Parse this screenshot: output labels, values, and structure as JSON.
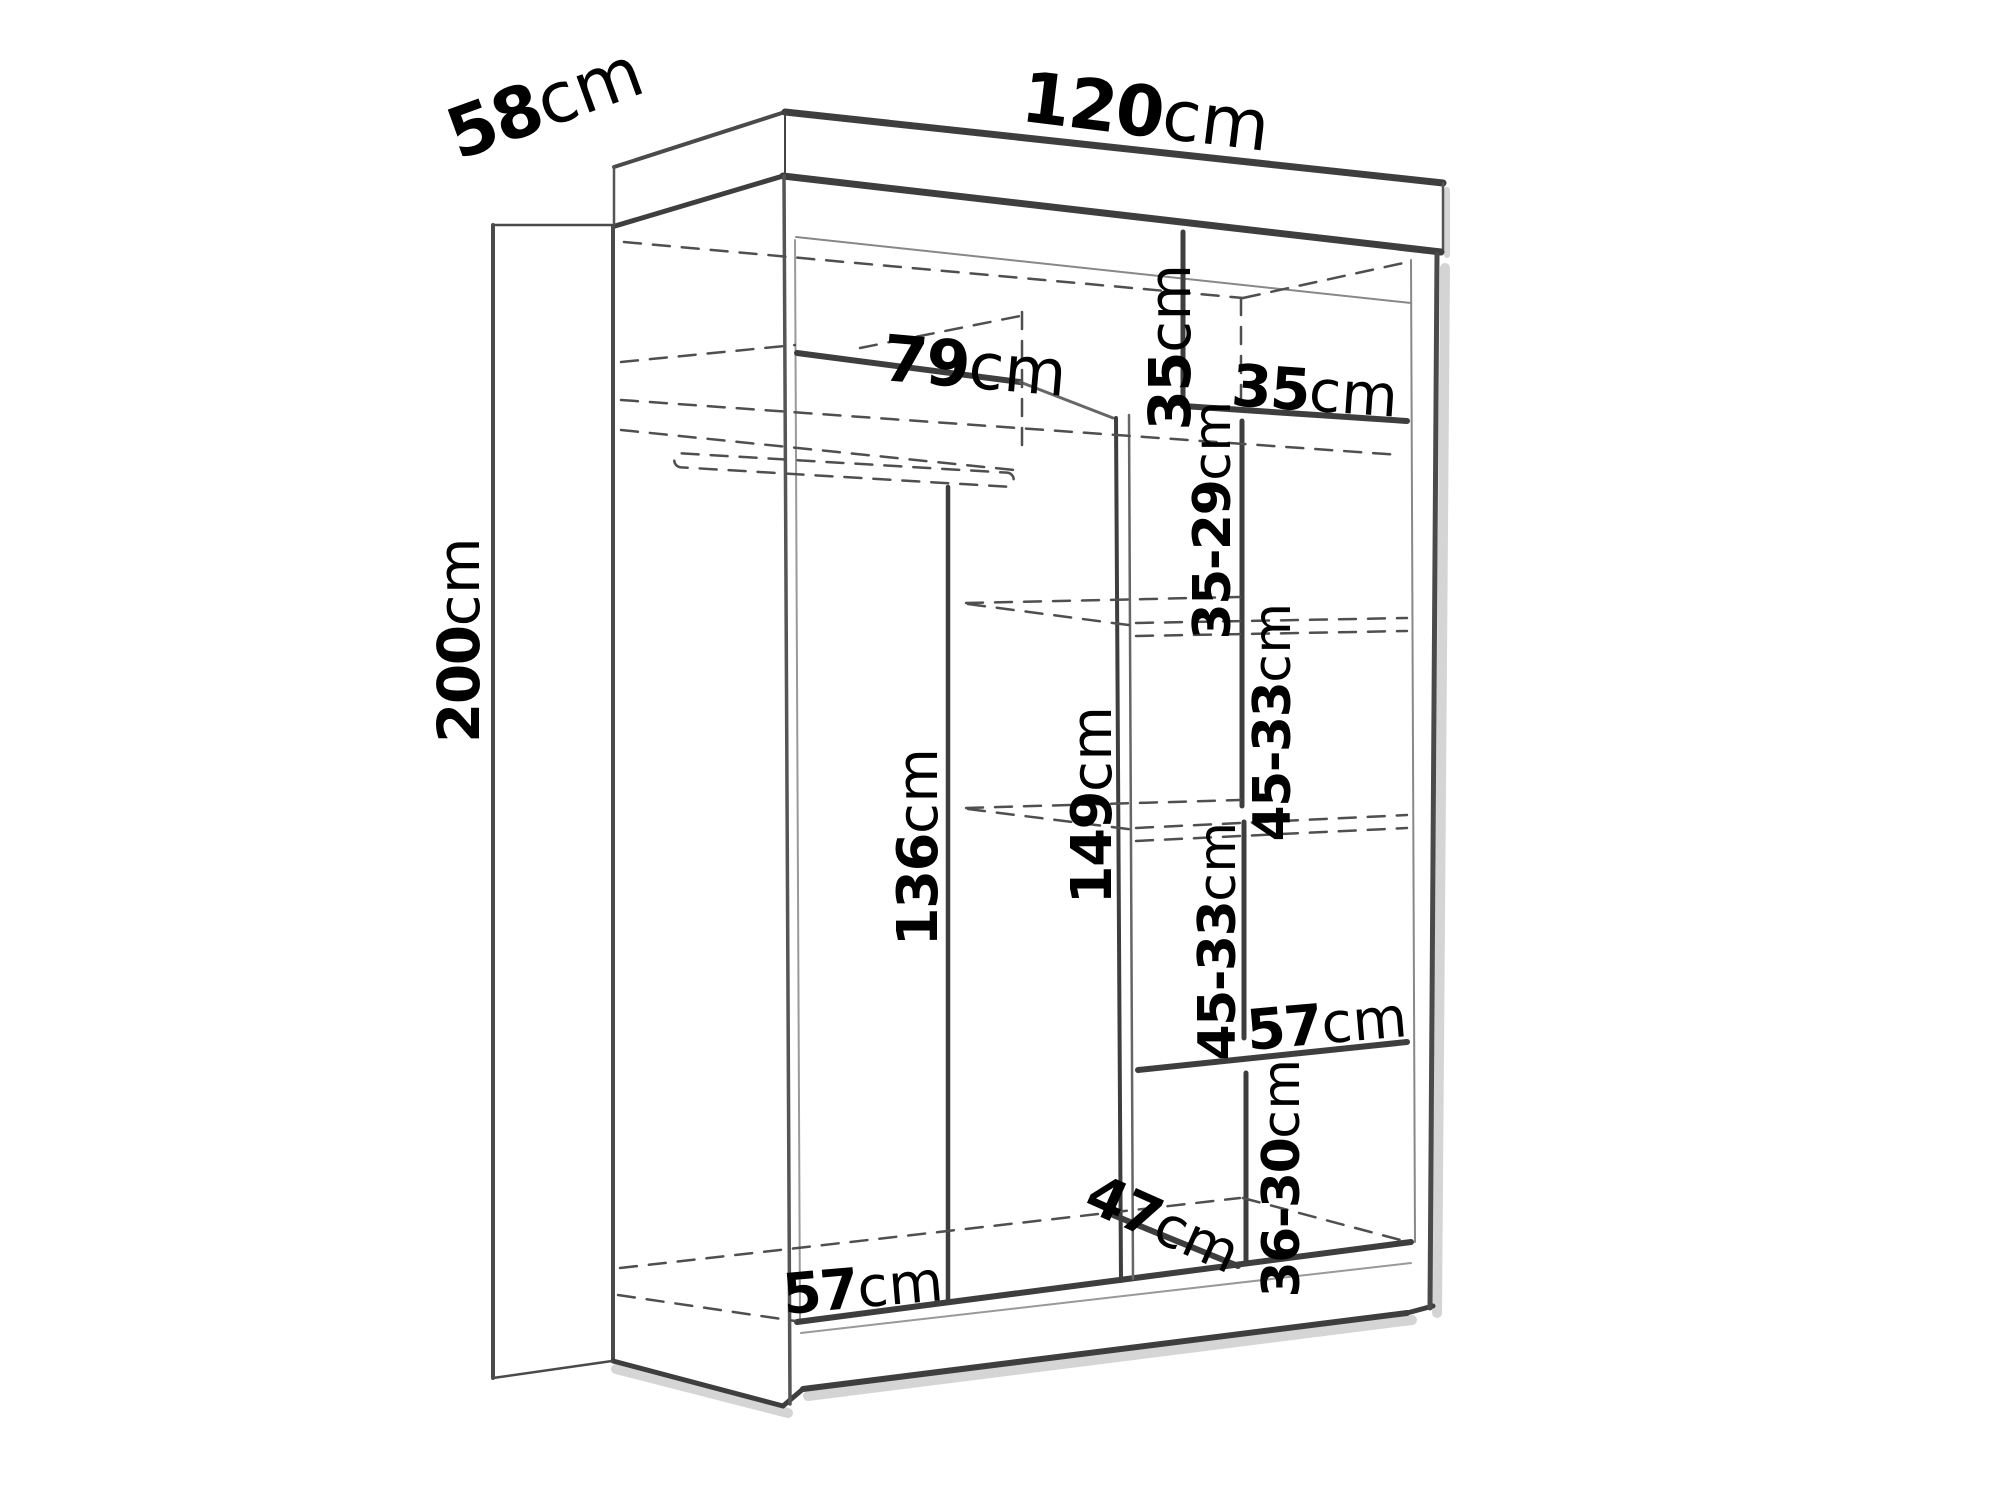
{
  "meta": {
    "title": "Wardrobe interior dimensions diagram",
    "background_color": "#ffffff",
    "line_color": "#3e3e3e",
    "dashed_line_color": "#4f4f4f",
    "shadow_color": "#d0d0d0",
    "text_color": "#000000"
  },
  "dimensions": {
    "depth": {
      "value": "58",
      "unit": "cm"
    },
    "width": {
      "value": "120",
      "unit": "cm"
    },
    "height": {
      "value": "200",
      "unit": "cm"
    },
    "top_shelf_width": {
      "value": "79",
      "unit": "cm"
    },
    "top_right_niche_height": {
      "value": "35",
      "unit": "cm"
    },
    "top_right_niche_width": {
      "value": "35",
      "unit": "cm"
    },
    "right_gap_top": {
      "value": "35-29",
      "unit": "cm"
    },
    "right_gap_upper_middle": {
      "value": "45-33",
      "unit": "cm"
    },
    "right_gap_lower_middle": {
      "value": "45-33",
      "unit": "cm"
    },
    "left_interior_height": {
      "value": "136",
      "unit": "cm"
    },
    "middle_divider_height": {
      "value": "149",
      "unit": "cm"
    },
    "right_shelf_width": {
      "value": "57",
      "unit": "cm"
    },
    "right_gap_bottom": {
      "value": "36-30",
      "unit": "cm"
    },
    "bottom_compartment_depth": {
      "value": "47",
      "unit": "cm"
    },
    "left_floor_width": {
      "value": "57",
      "unit": "cm"
    }
  }
}
